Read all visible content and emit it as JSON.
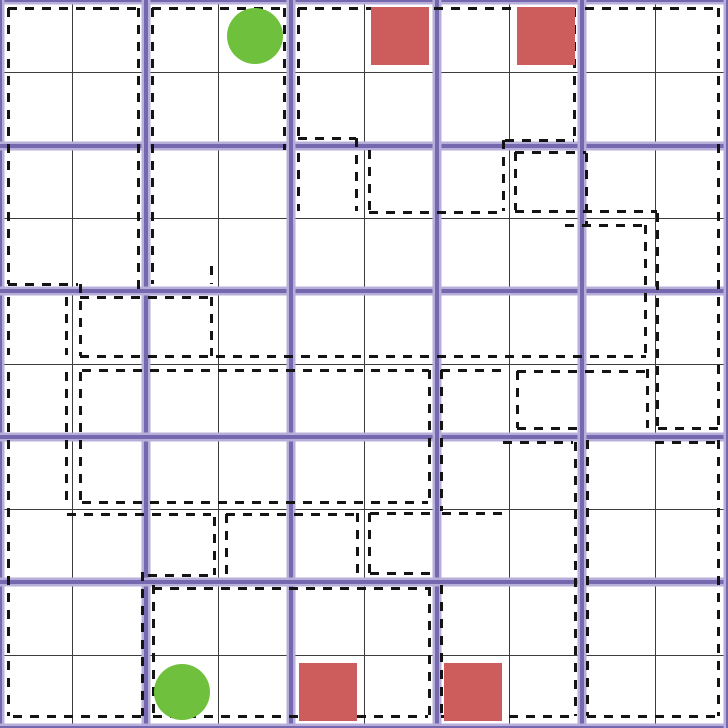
{
  "board": {
    "size_px": 728,
    "grid_cells": 10,
    "cell_px": 72.8,
    "block_size_cells": 2,
    "block_line_positions": [
      0,
      145.6,
      291.2,
      436.8,
      582.4,
      728
    ],
    "thin_line_positions": [
      72.8,
      218.4,
      364,
      509.6,
      655.2
    ]
  },
  "colors": {
    "background": "#ffffff",
    "thin_grid_line": "#3c3c3c",
    "block_line_core": "#7568ae",
    "block_line_halo": "#b7afd9",
    "region_dash": "#141414",
    "green_piece": "#6fc13d",
    "red_piece": "#cd5c5c"
  },
  "pieces": [
    {
      "type": "circle",
      "color_key": "green_piece",
      "row": 0,
      "col": 3,
      "size": 56
    },
    {
      "type": "circle",
      "color_key": "green_piece",
      "row": 9,
      "col": 2,
      "size": 56
    },
    {
      "type": "square",
      "color_key": "red_piece",
      "row": 0,
      "col": 5,
      "size": 58
    },
    {
      "type": "square",
      "color_key": "red_piece",
      "row": 0,
      "col": 7,
      "size": 58
    },
    {
      "type": "square",
      "color_key": "red_piece",
      "row": 9,
      "col": 4,
      "size": 58
    },
    {
      "type": "square",
      "color_key": "red_piece",
      "row": 9,
      "col": 6,
      "size": 58
    }
  ],
  "region_outlines": {
    "dash_thickness": 3,
    "dash_on": 9,
    "dash_off": 8,
    "horizontal_segments": [
      [
        8,
        8,
        138
      ],
      [
        8,
        152,
        284
      ],
      [
        8,
        298,
        574
      ],
      [
        8,
        585,
        718
      ],
      [
        138,
        298,
        356
      ],
      [
        140,
        505,
        574
      ],
      [
        152,
        515,
        586
      ],
      [
        211,
        515,
        657
      ],
      [
        212,
        369,
        503
      ],
      [
        225,
        565,
        645
      ],
      [
        284,
        8,
        78
      ],
      [
        297,
        80,
        211
      ],
      [
        356,
        80,
        646
      ],
      [
        370,
        82,
        429
      ],
      [
        370,
        441,
        502
      ],
      [
        371,
        517,
        647
      ],
      [
        428,
        517,
        578
      ],
      [
        428,
        658,
        718
      ],
      [
        442,
        503,
        573
      ],
      [
        442,
        655,
        718
      ],
      [
        502,
        82,
        428
      ],
      [
        513,
        442,
        509
      ],
      [
        513,
        370,
        436
      ],
      [
        514,
        67,
        211
      ],
      [
        514,
        226,
        358
      ],
      [
        573,
        370,
        436
      ],
      [
        575,
        148,
        213
      ],
      [
        588,
        153,
        429
      ],
      [
        716,
        13,
        142
      ],
      [
        716,
        153,
        428
      ],
      [
        716,
        441,
        573
      ],
      [
        716,
        587,
        716
      ]
    ],
    "vertical_segments": [
      [
        8,
        8,
        284
      ],
      [
        8,
        297,
        355
      ],
      [
        8,
        372,
        716
      ],
      [
        66,
        297,
        355
      ],
      [
        66,
        372,
        506
      ],
      [
        80,
        284,
        356
      ],
      [
        80,
        372,
        500
      ],
      [
        138,
        8,
        291
      ],
      [
        152,
        8,
        284
      ],
      [
        142,
        572,
        716
      ],
      [
        153,
        585,
        716
      ],
      [
        211,
        266,
        284
      ],
      [
        211,
        297,
        356
      ],
      [
        214,
        517,
        575
      ],
      [
        226,
        514,
        582
      ],
      [
        284,
        8,
        150
      ],
      [
        298,
        8,
        138
      ],
      [
        298,
        153,
        211
      ],
      [
        356,
        138,
        211
      ],
      [
        369,
        150,
        212
      ],
      [
        357,
        513,
        580
      ],
      [
        369,
        513,
        573
      ],
      [
        429,
        370,
        502
      ],
      [
        441,
        370,
        511
      ],
      [
        429,
        587,
        716
      ],
      [
        441,
        585,
        716
      ],
      [
        503,
        140,
        211
      ],
      [
        515,
        152,
        210
      ],
      [
        517,
        371,
        428
      ],
      [
        574,
        8,
        140
      ],
      [
        586,
        153,
        225
      ],
      [
        575,
        442,
        716
      ],
      [
        587,
        440,
        716
      ],
      [
        645,
        225,
        356
      ],
      [
        647,
        369,
        428
      ],
      [
        657,
        213,
        428
      ],
      [
        718,
        8,
        428
      ],
      [
        718,
        440,
        716
      ]
    ]
  }
}
